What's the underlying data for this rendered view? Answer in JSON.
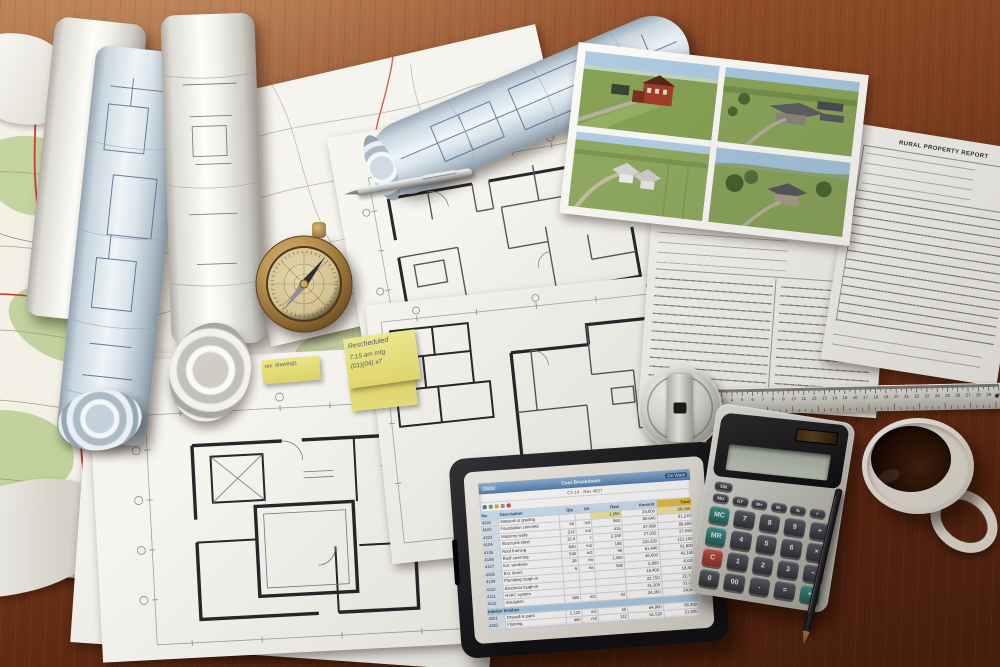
{
  "scene": {
    "title": "Architect desk with blueprints, site maps, aerial photos, tablet and calculator"
  },
  "stickies": {
    "note_top": {
      "lines": [
        "Rescheduled",
        "7:15 am  mtg",
        "(01)(04) x7"
      ]
    },
    "tab": {
      "line": "rev. drawings"
    }
  },
  "form_document": {
    "title": "RURAL PROPERTY REPORT"
  },
  "financial_document": {
    "heading": "Worksheet",
    "pie_slices": [
      {
        "color": "#e9c94e",
        "pct": 62
      },
      {
        "color": "#f6efd9",
        "pct": 23
      },
      {
        "color": "#d89a2b",
        "pct": 15
      }
    ]
  },
  "ruler": {
    "cm_numbers": [
      "1",
      "2",
      "3",
      "4",
      "5",
      "6",
      "7",
      "8",
      "9",
      "10",
      "11",
      "12",
      "13",
      "14",
      "15",
      "16",
      "17",
      "18",
      "19",
      "20",
      "21",
      "22",
      "23",
      "24",
      "25",
      "26",
      "27",
      "28",
      "29",
      "30"
    ],
    "red_at": [
      10,
      20,
      30
    ]
  },
  "calculator": {
    "power_key": "ON",
    "function_keys": [
      "MU",
      "GT",
      "M+",
      "M-",
      "%",
      "√"
    ],
    "key_rows": [
      [
        "MC",
        "7",
        "8",
        "9",
        "÷"
      ],
      [
        "MR",
        "4",
        "5",
        "6",
        "×"
      ],
      [
        "C",
        "1",
        "2",
        "3",
        "−"
      ],
      [
        "0",
        "00",
        ".",
        "=",
        "+"
      ]
    ],
    "accent_keys": {
      "red": [
        "C"
      ],
      "teal_small": [
        "MC",
        "MR"
      ],
      "teal_big": [
        "+"
      ]
    }
  },
  "tablet": {
    "title_left": "Done",
    "title_center": "Cost Breakdown",
    "title_right": "On Work",
    "subtitle": "Ch 14 · Rev 4827",
    "columns": [
      "No",
      "Description",
      "Qty",
      "Un",
      "Rate",
      "Amount",
      "Total"
    ],
    "col_widths": [
      8,
      30,
      7,
      7,
      14,
      17,
      17
    ],
    "section_label": "Interior finishes",
    "footer": "Subtotal carried forward — 731,080",
    "rows": [
      [
        "4101",
        "Sitework & grading",
        "",
        "",
        "1,250",
        "24,800",
        "26,040"
      ],
      [
        "4102",
        "Foundation concrete",
        "84",
        "m3",
        "960",
        "80,640",
        "81,210"
      ],
      [
        "4103",
        "Masonry walls",
        "212",
        "m2",
        "415",
        "87,980",
        "88,400"
      ],
      [
        "4104",
        "Structural steel",
        "12.4",
        "t",
        "2,180",
        "27,032",
        "27,560"
      ],
      [
        "4105",
        "Roof framing",
        "640",
        "m2",
        "188",
        "120,320",
        "121,100"
      ],
      [
        "4106",
        "Roof covering",
        "640",
        "m2",
        "96",
        "61,440",
        "61,800"
      ],
      [
        "4107",
        "Ext. windows",
        "28",
        "ea",
        "1,450",
        "40,600",
        "41,150"
      ],
      [
        "4108",
        "Ext. doors",
        "6",
        "ea",
        "980",
        "5,880",
        "6,020"
      ],
      [
        "4109",
        "Plumbing rough-in",
        "",
        "",
        "",
        "18,400",
        "18,400"
      ],
      [
        "4110",
        "Electrical rough-in",
        "",
        "",
        "",
        "22,750",
        "22,750"
      ],
      [
        "4111",
        "HVAC system",
        "",
        "",
        "",
        "31,200",
        "31,200"
      ],
      [
        "4112",
        "Insulation",
        "580",
        "m2",
        "42",
        "24,360",
        "24,500"
      ],
      {
        "section": "Interior finishes"
      },
      [
        "4201",
        "Drywall & paint",
        "1,120",
        "m2",
        "58",
        "64,960",
        "65,300"
      ],
      [
        "4202",
        "Flooring",
        "460",
        "m2",
        "112",
        "51,520",
        "51,900"
      ],
      [
        "4203",
        "Kitchen fit-out",
        "",
        "",
        "",
        "28,900",
        "28,900"
      ],
      [
        "4204",
        "Bathrooms",
        "3",
        "ea",
        "7,400",
        "22,200",
        "22,400"
      ],
      [
        "4205",
        "Trim & millwork",
        "",
        "",
        "",
        "12,600",
        "12,600"
      ],
      [
        "4206",
        "Fixtures & equip.",
        "",
        "",
        "",
        "9,850",
        "9,850"
      ]
    ]
  }
}
